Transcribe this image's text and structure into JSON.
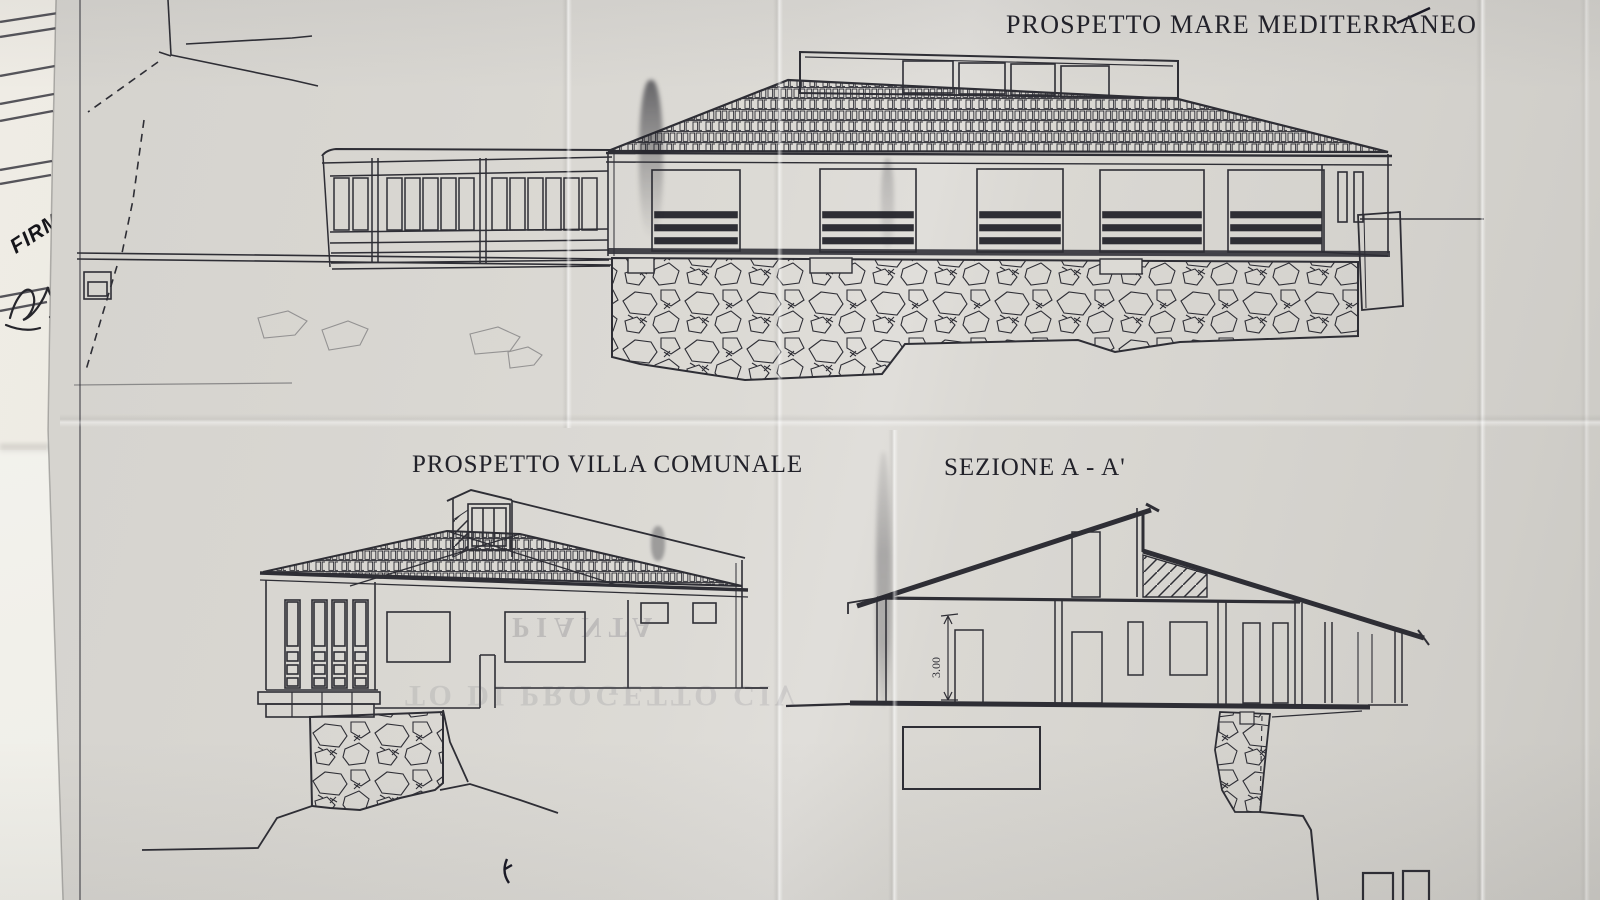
{
  "titles": {
    "sea_elevation": "PROSPETTO MARE MEDITERRANEO",
    "villa_elevation": "PROSPETTO VILLA COMUNALE",
    "section": "SEZIONE A - A'"
  },
  "labels": {
    "dimension_height": "3.00",
    "signature_stamp": "FIRM"
  },
  "bleedthrough": {
    "line1": "PIANTA",
    "line2": "TO DI PROGETTO CIV"
  },
  "colors": {
    "paper": "#d8d6d1",
    "underlay_paper": "#ece9e2",
    "table": "#f3f2ee",
    "ink": "#2e2e35",
    "title_ink": "#22222a"
  }
}
